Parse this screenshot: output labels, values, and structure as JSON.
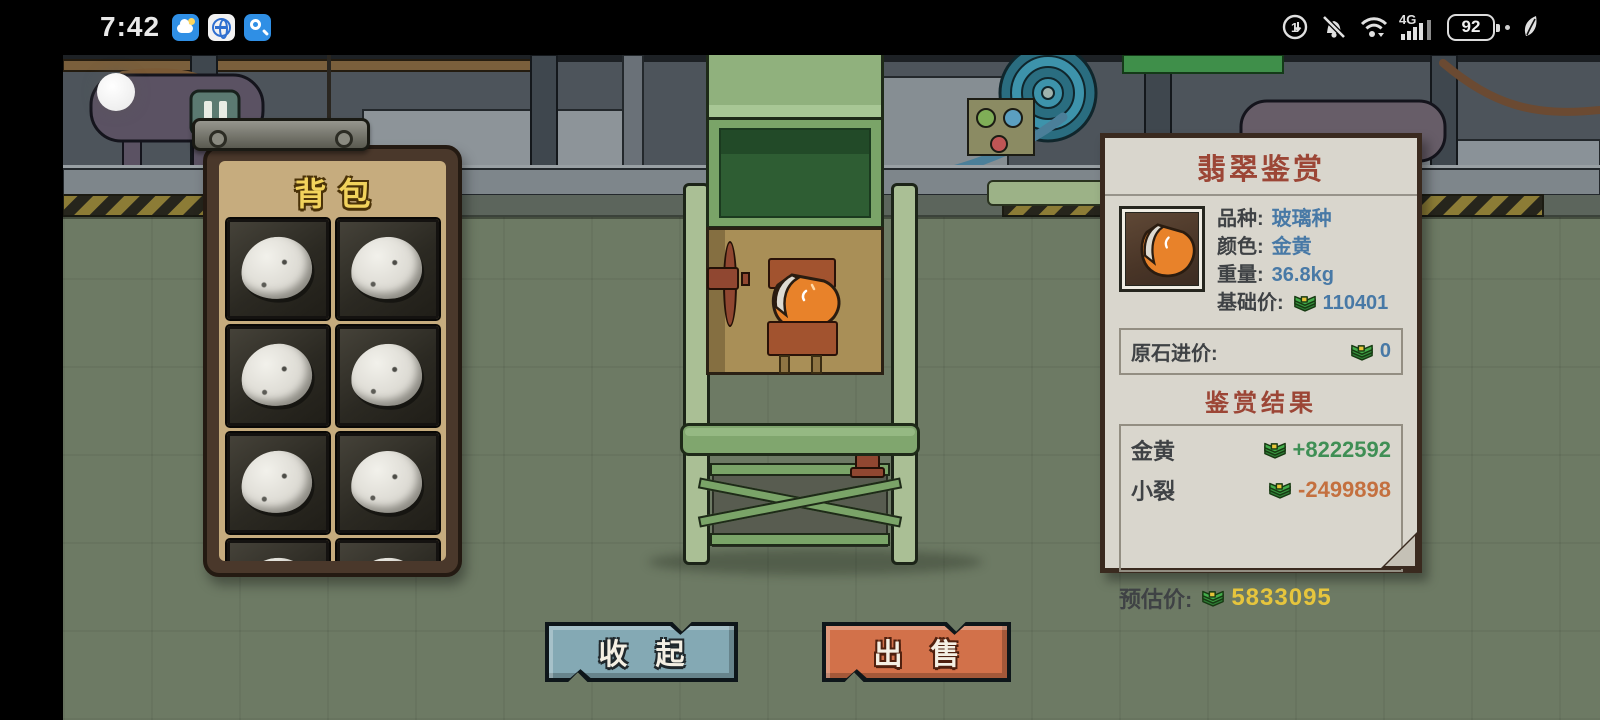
{
  "status_bar": {
    "time": "7:42",
    "network_label": "4G",
    "battery_percent": "92",
    "app_icons": [
      "weather-app-icon",
      "browser-app-icon",
      "search-app-icon"
    ],
    "system_icons": [
      "data-saver-icon",
      "mute-bell-icon",
      "wifi-icon",
      "signal-bars-icon",
      "battery-icon",
      "power-save-leaf-icon"
    ]
  },
  "backpack": {
    "title": "背包",
    "visible_slots": 8,
    "slots": [
      {
        "item": "raw-stone"
      },
      {
        "item": "raw-stone"
      },
      {
        "item": "raw-stone"
      },
      {
        "item": "raw-stone"
      },
      {
        "item": "raw-stone"
      },
      {
        "item": "raw-stone"
      },
      {
        "item": "raw-stone"
      },
      {
        "item": "raw-stone"
      }
    ]
  },
  "appraisal": {
    "title": "翡翠鉴赏",
    "item_image": "golden-jade-stone",
    "fields": [
      {
        "label": "品种:",
        "value": "玻璃种"
      },
      {
        "label": "颜色:",
        "value": "金黄"
      },
      {
        "label": "重量:",
        "value": "36.8kg"
      },
      {
        "label": "基础价:",
        "value": "110401",
        "icon": "money-icon"
      }
    ],
    "purchase_row": {
      "label": "原石进价:",
      "value": "0",
      "icon": "money-icon"
    },
    "results_title": "鉴赏结果",
    "results": [
      {
        "name": "金黄",
        "value": "+8222592",
        "sign": "positive"
      },
      {
        "name": "小裂",
        "value": "-2499898",
        "sign": "negative"
      }
    ],
    "estimate_row": {
      "label": "预估价:",
      "value": "5833095",
      "icon": "money-icon"
    }
  },
  "buttons": {
    "collapse": "收 起",
    "sell": "出 售"
  },
  "colors": {
    "value_blue": "#4879a6",
    "positive_green": "#3f8f55",
    "negative_orange": "#c4703f",
    "estimate_yellow": "#e6c53d",
    "panel_title_red": "#9c4636",
    "backpack_title_yellow": "#f2d35c",
    "collapse_button_teal": "#84a9b4",
    "sell_button_orange": "#d2714a",
    "machine_green": "#7aa468",
    "gem_orange": "#e8822a"
  }
}
